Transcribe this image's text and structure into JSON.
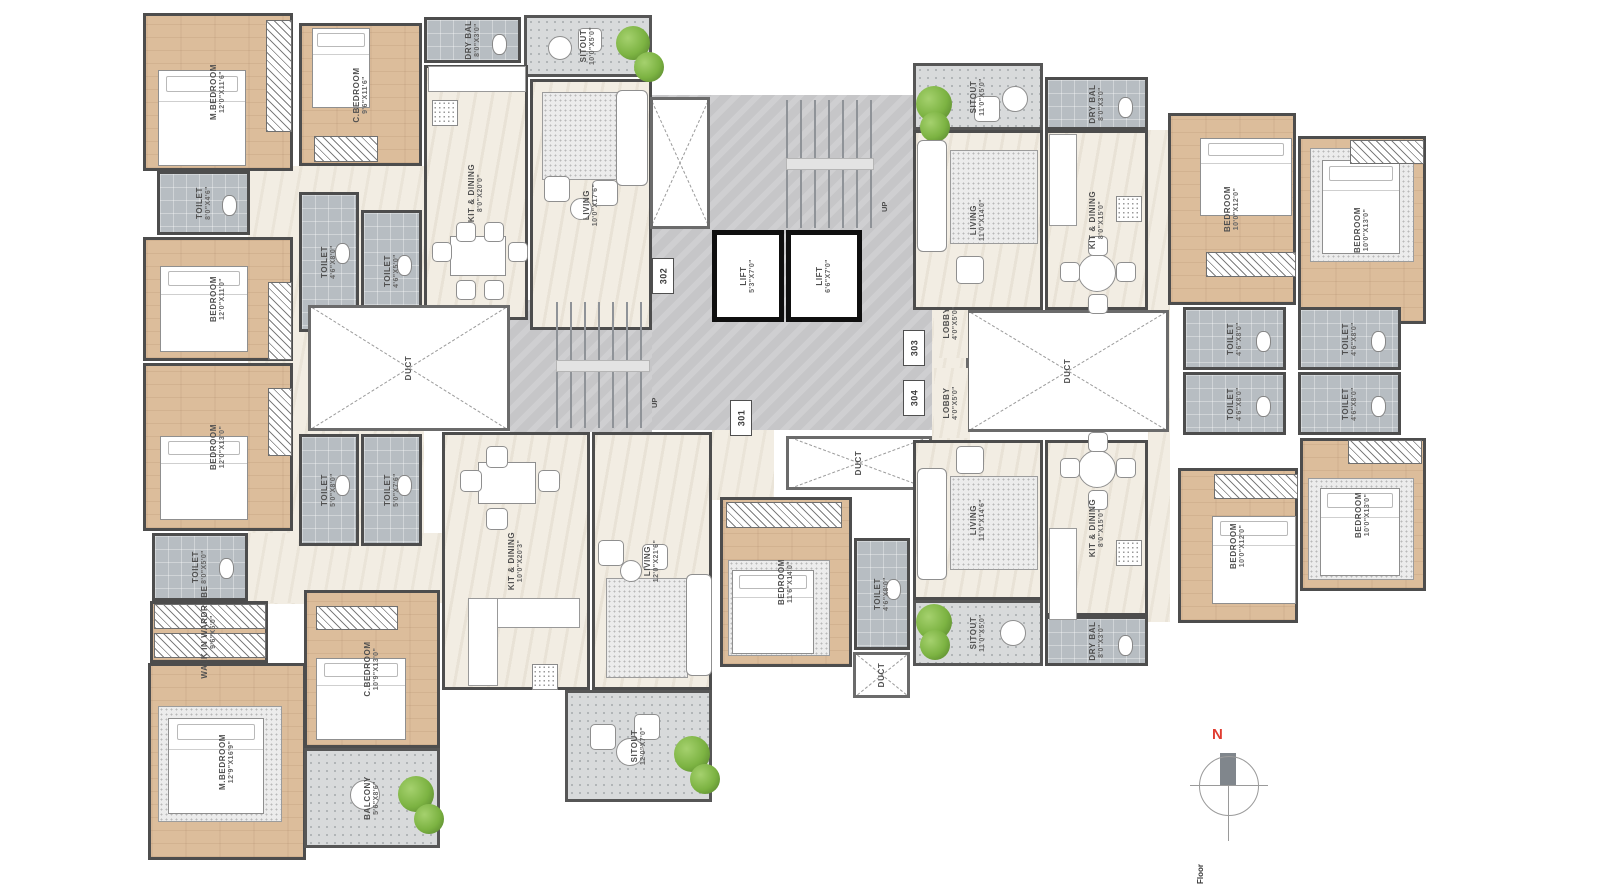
{
  "palette": {
    "wood": "#dcbd9b",
    "cream": "#f2ede3",
    "tile": "#b7bdc2",
    "core_gray": "#c6c6c8",
    "wall": "#4d4d4d",
    "lift_wall": "#0f0f0f",
    "tree_green": "#7cb342",
    "north_red": "#e03c31"
  },
  "compass": {
    "north_label": "N"
  },
  "footer": {
    "text": "Floor"
  },
  "stairs": {
    "up_labels": [
      {
        "t": "UP",
        "x": 880,
        "y": 212
      },
      {
        "t": "UP",
        "x": 650,
        "y": 408
      }
    ]
  },
  "unit_plates": [
    {
      "t": "302",
      "x": 652,
      "y": 258
    },
    {
      "t": "301",
      "x": 730,
      "y": 400
    },
    {
      "t": "303",
      "x": 903,
      "y": 330
    },
    {
      "t": "304",
      "x": 903,
      "y": 380
    }
  ],
  "rooms": [
    {
      "label": "",
      "dims": "",
      "x": 248,
      "y": 166,
      "w": 176,
      "h": 438,
      "kind": "open"
    },
    {
      "label": "",
      "dims": "",
      "x": 248,
      "y": 533,
      "w": 196,
      "h": 70,
      "kind": "open"
    },
    {
      "label": "",
      "dims": "",
      "x": 712,
      "y": 430,
      "w": 62,
      "h": 70,
      "kind": "open"
    },
    {
      "label": "",
      "dims": "",
      "x": 932,
      "y": 230,
      "w": 38,
      "h": 210,
      "kind": "open"
    },
    {
      "label": "",
      "dims": "",
      "x": 1148,
      "y": 130,
      "w": 22,
      "h": 492,
      "kind": "open"
    },
    {
      "label": "",
      "dims": "",
      "x": 648,
      "y": 95,
      "w": 284,
      "h": 335,
      "kind": "core"
    },
    {
      "label": "",
      "dims": "",
      "x": 510,
      "y": 300,
      "w": 142,
      "h": 132,
      "kind": "core"
    },
    {
      "label": "M.BEDROOM",
      "dims": "12'0\"X11'6\"",
      "x": 143,
      "y": 13,
      "w": 150,
      "h": 158,
      "kind": "wood"
    },
    {
      "label": "C.BEDROOM",
      "dims": "9'6\"X11'6\"",
      "x": 299,
      "y": 23,
      "w": 123,
      "h": 143,
      "kind": "wood"
    },
    {
      "label": "TOILET",
      "dims": "8'0\"X4'6\"",
      "x": 157,
      "y": 171,
      "w": 93,
      "h": 64,
      "kind": "tile"
    },
    {
      "label": "DRY BAL",
      "dims": "8'0\"X3'0\"",
      "x": 424,
      "y": 17,
      "w": 97,
      "h": 46,
      "kind": "tile"
    },
    {
      "label": "SITOUT",
      "dims": "10'0\"X5'0\"",
      "x": 524,
      "y": 15,
      "w": 128,
      "h": 62,
      "kind": "pattern"
    },
    {
      "label": "KIT & DINING",
      "dims": "8'0\"X20'0\"",
      "x": 424,
      "y": 65,
      "w": 104,
      "h": 255,
      "kind": "cream"
    },
    {
      "label": "LIVING",
      "dims": "10'0\"X17'6\"",
      "x": 530,
      "y": 79,
      "w": 122,
      "h": 251,
      "kind": "cream"
    },
    {
      "label": "BEDROOM",
      "dims": "12'0\"X11'0\"",
      "x": 143,
      "y": 237,
      "w": 150,
      "h": 124,
      "kind": "wood"
    },
    {
      "label": "TOILET",
      "dims": "4'6\"X8'0\"",
      "x": 299,
      "y": 192,
      "w": 60,
      "h": 140,
      "kind": "tile"
    },
    {
      "label": "TOILET",
      "dims": "4'6\"X5'0\"",
      "x": 361,
      "y": 210,
      "w": 61,
      "h": 122,
      "kind": "tile"
    },
    {
      "label": "BEDROOM",
      "dims": "12'0\"X13'0\"",
      "x": 143,
      "y": 363,
      "w": 150,
      "h": 168,
      "kind": "wood"
    },
    {
      "label": "DUCT",
      "dims": "",
      "x": 308,
      "y": 305,
      "w": 202,
      "h": 126,
      "kind": "duct"
    },
    {
      "label": "TOILET",
      "dims": "5'0\"X8'0\"",
      "x": 299,
      "y": 434,
      "w": 60,
      "h": 112,
      "kind": "tile"
    },
    {
      "label": "TOILET",
      "dims": "5'0\"X7'6\"",
      "x": 361,
      "y": 434,
      "w": 61,
      "h": 112,
      "kind": "tile"
    },
    {
      "label": "TOILET",
      "dims": "8'0\"X5'0\"",
      "x": 152,
      "y": 533,
      "w": 96,
      "h": 68,
      "kind": "tile"
    },
    {
      "label": "WALK IN WARDROBE",
      "dims": "9'6\"X5'0\"",
      "x": 150,
      "y": 601,
      "w": 118,
      "h": 62,
      "kind": "wood"
    },
    {
      "label": "M.BEDROOM",
      "dims": "12'9\"X16'9\"",
      "x": 148,
      "y": 663,
      "w": 158,
      "h": 197,
      "kind": "wood"
    },
    {
      "label": "C.BEDROOM",
      "dims": "10'9\"X13'0\"",
      "x": 304,
      "y": 590,
      "w": 136,
      "h": 158,
      "kind": "wood"
    },
    {
      "label": "BALCONY",
      "dims": "5'6\"X8'6\"",
      "x": 304,
      "y": 748,
      "w": 136,
      "h": 100,
      "kind": "pattern"
    },
    {
      "label": "KIT & DINING",
      "dims": "10'0\"X20'3\"",
      "x": 442,
      "y": 432,
      "w": 148,
      "h": 258,
      "kind": "cream"
    },
    {
      "label": "LIVING",
      "dims": "12'0\"X21'6\"",
      "x": 592,
      "y": 432,
      "w": 120,
      "h": 258,
      "kind": "cream"
    },
    {
      "label": "SITOUT",
      "dims": "12'0\"X7'0\"",
      "x": 565,
      "y": 690,
      "w": 147,
      "h": 112,
      "kind": "pattern"
    },
    {
      "label": "",
      "dims": "",
      "x": 650,
      "y": 97,
      "w": 60,
      "h": 132,
      "kind": "duct"
    },
    {
      "label": "LIFT",
      "dims": "5'3\"X7'0\"",
      "x": 712,
      "y": 230,
      "w": 72,
      "h": 92,
      "kind": "lift"
    },
    {
      "label": "LIFT",
      "dims": "6'6\"X7'0\"",
      "x": 786,
      "y": 230,
      "w": 76,
      "h": 92,
      "kind": "lift"
    },
    {
      "label": "DUCT",
      "dims": "",
      "x": 966,
      "y": 310,
      "w": 203,
      "h": 122,
      "kind": "duct"
    },
    {
      "label": "DUCT",
      "dims": "",
      "x": 786,
      "y": 436,
      "w": 146,
      "h": 54,
      "kind": "duct"
    },
    {
      "label": "DUCT",
      "dims": "",
      "x": 853,
      "y": 652,
      "w": 57,
      "h": 46,
      "kind": "duct"
    },
    {
      "label": "LOBBY",
      "dims": "4'0\"X5'0\"",
      "x": 934,
      "y": 288,
      "w": 34,
      "h": 70,
      "kind": "open"
    },
    {
      "label": "LOBBY",
      "dims": "4'0\"X5'0\"",
      "x": 934,
      "y": 368,
      "w": 34,
      "h": 70,
      "kind": "open"
    },
    {
      "label": "SITOUT",
      "dims": "11'0\"X5'0\"",
      "x": 913,
      "y": 63,
      "w": 130,
      "h": 67,
      "kind": "pattern"
    },
    {
      "label": "DRY BAL",
      "dims": "8'0\"X3'0\"",
      "x": 1045,
      "y": 77,
      "w": 103,
      "h": 53,
      "kind": "tile"
    },
    {
      "label": "LIVING",
      "dims": "11'0\"X14'0\"",
      "x": 913,
      "y": 130,
      "w": 130,
      "h": 180,
      "kind": "cream"
    },
    {
      "label": "KIT & DINING",
      "dims": "8'0\"X15'0\"",
      "x": 1045,
      "y": 130,
      "w": 103,
      "h": 180,
      "kind": "cream"
    },
    {
      "label": "BEDROOM",
      "dims": "10'0\"X12'0\"",
      "x": 1168,
      "y": 113,
      "w": 128,
      "h": 192,
      "kind": "wood"
    },
    {
      "label": "BEDROOM",
      "dims": "10'0\"X13'0\"",
      "x": 1298,
      "y": 136,
      "w": 128,
      "h": 188,
      "kind": "wood"
    },
    {
      "label": "TOILET",
      "dims": "4'6\"X8'0\"",
      "x": 1183,
      "y": 307,
      "w": 103,
      "h": 63,
      "kind": "tile"
    },
    {
      "label": "TOILET",
      "dims": "4'6\"X8'0\"",
      "x": 1298,
      "y": 307,
      "w": 103,
      "h": 63,
      "kind": "tile"
    },
    {
      "label": "TOILET",
      "dims": "4'6\"X8'0\"",
      "x": 1183,
      "y": 372,
      "w": 103,
      "h": 63,
      "kind": "tile"
    },
    {
      "label": "TOILET",
      "dims": "4'6\"X8'0\"",
      "x": 1298,
      "y": 372,
      "w": 103,
      "h": 63,
      "kind": "tile"
    },
    {
      "label": "LIVING",
      "dims": "11'0\"X14'6\"",
      "x": 913,
      "y": 440,
      "w": 130,
      "h": 160,
      "kind": "cream"
    },
    {
      "label": "KIT & DINING",
      "dims": "8'0\"X15'0\"",
      "x": 1045,
      "y": 440,
      "w": 103,
      "h": 176,
      "kind": "cream"
    },
    {
      "label": "SITOUT",
      "dims": "11'0\"X5'0\"",
      "x": 913,
      "y": 600,
      "w": 130,
      "h": 66,
      "kind": "pattern"
    },
    {
      "label": "DRY BAL",
      "dims": "8'0\"X3'0\"",
      "x": 1045,
      "y": 616,
      "w": 103,
      "h": 50,
      "kind": "tile"
    },
    {
      "label": "BEDROOM",
      "dims": "10'0\"X12'0\"",
      "x": 1178,
      "y": 468,
      "w": 120,
      "h": 155,
      "kind": "wood"
    },
    {
      "label": "BEDROOM",
      "dims": "10'0\"X13'0\"",
      "x": 1300,
      "y": 438,
      "w": 126,
      "h": 153,
      "kind": "wood"
    },
    {
      "label": "BEDROOM",
      "dims": "11'6\"X14'0\"",
      "x": 720,
      "y": 497,
      "w": 132,
      "h": 170,
      "kind": "wood"
    },
    {
      "label": "TOILET",
      "dims": "4'6\"X8'0\"",
      "x": 854,
      "y": 538,
      "w": 56,
      "h": 112,
      "kind": "tile"
    }
  ],
  "furniture": [
    {
      "k": "bed",
      "x": 158,
      "y": 70,
      "w": 88,
      "h": 96
    },
    {
      "k": "hatch",
      "x": 266,
      "y": 20,
      "w": 26,
      "h": 112
    },
    {
      "k": "bed",
      "x": 312,
      "y": 28,
      "w": 58,
      "h": 80
    },
    {
      "k": "hatch",
      "x": 314,
      "y": 136,
      "w": 64,
      "h": 26
    },
    {
      "k": "counter",
      "x": 428,
      "y": 66,
      "w": 98,
      "h": 26
    },
    {
      "k": "dots",
      "x": 432,
      "y": 100,
      "w": 26,
      "h": 26
    },
    {
      "k": "tbl",
      "x": 450,
      "y": 236,
      "w": 56,
      "h": 40
    },
    {
      "k": "chair",
      "x": 432,
      "y": 242,
      "w": 20,
      "h": 20
    },
    {
      "k": "chair",
      "x": 508,
      "y": 242,
      "w": 20,
      "h": 20
    },
    {
      "k": "chair",
      "x": 456,
      "y": 222,
      "w": 20,
      "h": 20
    },
    {
      "k": "chair",
      "x": 484,
      "y": 222,
      "w": 20,
      "h": 20
    },
    {
      "k": "chair",
      "x": 456,
      "y": 280,
      "w": 20,
      "h": 20
    },
    {
      "k": "chair",
      "x": 484,
      "y": 280,
      "w": 20,
      "h": 20
    },
    {
      "k": "rug",
      "x": 542,
      "y": 92,
      "w": 82,
      "h": 88
    },
    {
      "k": "sofa",
      "x": 616,
      "y": 90,
      "w": 32,
      "h": 96
    },
    {
      "k": "chair",
      "x": 544,
      "y": 176,
      "w": 26,
      "h": 26
    },
    {
      "k": "chair",
      "x": 592,
      "y": 180,
      "w": 26,
      "h": 26
    },
    {
      "k": "round",
      "x": 570,
      "y": 198,
      "w": 22,
      "h": 22
    },
    {
      "k": "tree",
      "x": 616,
      "y": 26,
      "w": 34,
      "h": 34
    },
    {
      "k": "tree",
      "x": 634,
      "y": 52,
      "w": 30,
      "h": 30
    },
    {
      "k": "round",
      "x": 548,
      "y": 36,
      "w": 24,
      "h": 24
    },
    {
      "k": "chair",
      "x": 578,
      "y": 28,
      "w": 24,
      "h": 24
    },
    {
      "k": "bed",
      "x": 160,
      "y": 266,
      "w": 88,
      "h": 86
    },
    {
      "k": "hatch",
      "x": 268,
      "y": 282,
      "w": 24,
      "h": 78
    },
    {
      "k": "bed",
      "x": 160,
      "y": 436,
      "w": 88,
      "h": 84
    },
    {
      "k": "hatch",
      "x": 268,
      "y": 388,
      "w": 24,
      "h": 68
    },
    {
      "k": "hatch",
      "x": 154,
      "y": 604,
      "w": 112,
      "h": 25
    },
    {
      "k": "hatch",
      "x": 154,
      "y": 633,
      "w": 112,
      "h": 25
    },
    {
      "k": "rug",
      "x": 158,
      "y": 706,
      "w": 124,
      "h": 116
    },
    {
      "k": "bed",
      "x": 168,
      "y": 718,
      "w": 96,
      "h": 96
    },
    {
      "k": "hatch",
      "x": 316,
      "y": 606,
      "w": 82,
      "h": 24
    },
    {
      "k": "bed",
      "x": 316,
      "y": 658,
      "w": 90,
      "h": 82
    },
    {
      "k": "round",
      "x": 350,
      "y": 780,
      "w": 30,
      "h": 30
    },
    {
      "k": "tree",
      "x": 398,
      "y": 776,
      "w": 36,
      "h": 36
    },
    {
      "k": "tree",
      "x": 414,
      "y": 804,
      "w": 30,
      "h": 30
    },
    {
      "k": "counter",
      "x": 468,
      "y": 598,
      "w": 112,
      "h": 30
    },
    {
      "k": "counter",
      "x": 468,
      "y": 598,
      "w": 30,
      "h": 88
    },
    {
      "k": "dots",
      "x": 532,
      "y": 664,
      "w": 26,
      "h": 26
    },
    {
      "k": "tbl",
      "x": 478,
      "y": 462,
      "w": 58,
      "h": 42
    },
    {
      "k": "chair",
      "x": 460,
      "y": 470,
      "w": 22,
      "h": 22
    },
    {
      "k": "chair",
      "x": 538,
      "y": 470,
      "w": 22,
      "h": 22
    },
    {
      "k": "chair",
      "x": 486,
      "y": 446,
      "w": 22,
      "h": 22
    },
    {
      "k": "chair",
      "x": 486,
      "y": 508,
      "w": 22,
      "h": 22
    },
    {
      "k": "rug",
      "x": 606,
      "y": 578,
      "w": 82,
      "h": 100
    },
    {
      "k": "sofa",
      "x": 686,
      "y": 574,
      "w": 26,
      "h": 102
    },
    {
      "k": "chair",
      "x": 598,
      "y": 540,
      "w": 26,
      "h": 26
    },
    {
      "k": "chair",
      "x": 642,
      "y": 544,
      "w": 26,
      "h": 26
    },
    {
      "k": "round",
      "x": 620,
      "y": 560,
      "w": 22,
      "h": 22
    },
    {
      "k": "tree",
      "x": 674,
      "y": 736,
      "w": 36,
      "h": 36
    },
    {
      "k": "tree",
      "x": 690,
      "y": 764,
      "w": 30,
      "h": 30
    },
    {
      "k": "round",
      "x": 616,
      "y": 738,
      "w": 28,
      "h": 28
    },
    {
      "k": "chair",
      "x": 590,
      "y": 724,
      "w": 26,
      "h": 26
    },
    {
      "k": "chair",
      "x": 634,
      "y": 714,
      "w": 26,
      "h": 26
    },
    {
      "k": "hatch",
      "x": 726,
      "y": 502,
      "w": 116,
      "h": 26
    },
    {
      "k": "rug",
      "x": 728,
      "y": 560,
      "w": 102,
      "h": 96
    },
    {
      "k": "bed",
      "x": 732,
      "y": 570,
      "w": 82,
      "h": 84
    },
    {
      "k": "tree",
      "x": 916,
      "y": 86,
      "w": 36,
      "h": 36
    },
    {
      "k": "tree",
      "x": 920,
      "y": 112,
      "w": 30,
      "h": 30
    },
    {
      "k": "round",
      "x": 1002,
      "y": 86,
      "w": 26,
      "h": 26
    },
    {
      "k": "chair",
      "x": 974,
      "y": 96,
      "w": 26,
      "h": 26
    },
    {
      "k": "sofa",
      "x": 917,
      "y": 140,
      "w": 30,
      "h": 112
    },
    {
      "k": "rug",
      "x": 950,
      "y": 150,
      "w": 88,
      "h": 94
    },
    {
      "k": "chair",
      "x": 956,
      "y": 256,
      "w": 28,
      "h": 28
    },
    {
      "k": "counter",
      "x": 1049,
      "y": 134,
      "w": 28,
      "h": 92
    },
    {
      "k": "dots",
      "x": 1116,
      "y": 196,
      "w": 26,
      "h": 26
    },
    {
      "k": "tbl-r",
      "x": 1078,
      "y": 254,
      "w": 38,
      "h": 38
    },
    {
      "k": "chair",
      "x": 1060,
      "y": 262,
      "w": 20,
      "h": 20
    },
    {
      "k": "chair",
      "x": 1116,
      "y": 262,
      "w": 20,
      "h": 20
    },
    {
      "k": "chair",
      "x": 1088,
      "y": 236,
      "w": 20,
      "h": 20
    },
    {
      "k": "chair",
      "x": 1088,
      "y": 294,
      "w": 20,
      "h": 20
    },
    {
      "k": "bed",
      "x": 1200,
      "y": 138,
      "w": 92,
      "h": 78
    },
    {
      "k": "hatch",
      "x": 1206,
      "y": 252,
      "w": 90,
      "h": 25
    },
    {
      "k": "rug",
      "x": 1310,
      "y": 148,
      "w": 104,
      "h": 114
    },
    {
      "k": "bed",
      "x": 1322,
      "y": 160,
      "w": 78,
      "h": 94
    },
    {
      "k": "hatch",
      "x": 1350,
      "y": 140,
      "w": 74,
      "h": 24
    },
    {
      "k": "sofa",
      "x": 917,
      "y": 468,
      "w": 30,
      "h": 112
    },
    {
      "k": "rug",
      "x": 950,
      "y": 476,
      "w": 88,
      "h": 94
    },
    {
      "k": "chair",
      "x": 956,
      "y": 446,
      "w": 28,
      "h": 28
    },
    {
      "k": "tbl-r",
      "x": 1078,
      "y": 450,
      "w": 38,
      "h": 38
    },
    {
      "k": "chair",
      "x": 1060,
      "y": 458,
      "w": 20,
      "h": 20
    },
    {
      "k": "chair",
      "x": 1116,
      "y": 458,
      "w": 20,
      "h": 20
    },
    {
      "k": "chair",
      "x": 1088,
      "y": 432,
      "w": 20,
      "h": 20
    },
    {
      "k": "chair",
      "x": 1088,
      "y": 490,
      "w": 20,
      "h": 20
    },
    {
      "k": "counter",
      "x": 1049,
      "y": 528,
      "w": 28,
      "h": 92
    },
    {
      "k": "dots",
      "x": 1116,
      "y": 540,
      "w": 26,
      "h": 26
    },
    {
      "k": "tree",
      "x": 916,
      "y": 604,
      "w": 36,
      "h": 36
    },
    {
      "k": "tree",
      "x": 920,
      "y": 630,
      "w": 30,
      "h": 30
    },
    {
      "k": "round",
      "x": 1000,
      "y": 620,
      "w": 26,
      "h": 26
    },
    {
      "k": "hatch",
      "x": 1214,
      "y": 474,
      "w": 84,
      "h": 25
    },
    {
      "k": "bed",
      "x": 1212,
      "y": 516,
      "w": 84,
      "h": 88
    },
    {
      "k": "rug",
      "x": 1308,
      "y": 478,
      "w": 106,
      "h": 102
    },
    {
      "k": "bed",
      "x": 1320,
      "y": 488,
      "w": 80,
      "h": 88
    },
    {
      "k": "hatch",
      "x": 1348,
      "y": 440,
      "w": 74,
      "h": 24
    },
    {
      "k": "stairs-h",
      "x": 786,
      "y": 100,
      "w": 88,
      "h": 128
    },
    {
      "k": "landing",
      "x": 786,
      "y": 158,
      "w": 88,
      "h": 12
    },
    {
      "k": "stairs-h",
      "x": 556,
      "y": 302,
      "w": 94,
      "h": 126
    },
    {
      "k": "landing",
      "x": 556,
      "y": 360,
      "w": 94,
      "h": 12
    }
  ]
}
